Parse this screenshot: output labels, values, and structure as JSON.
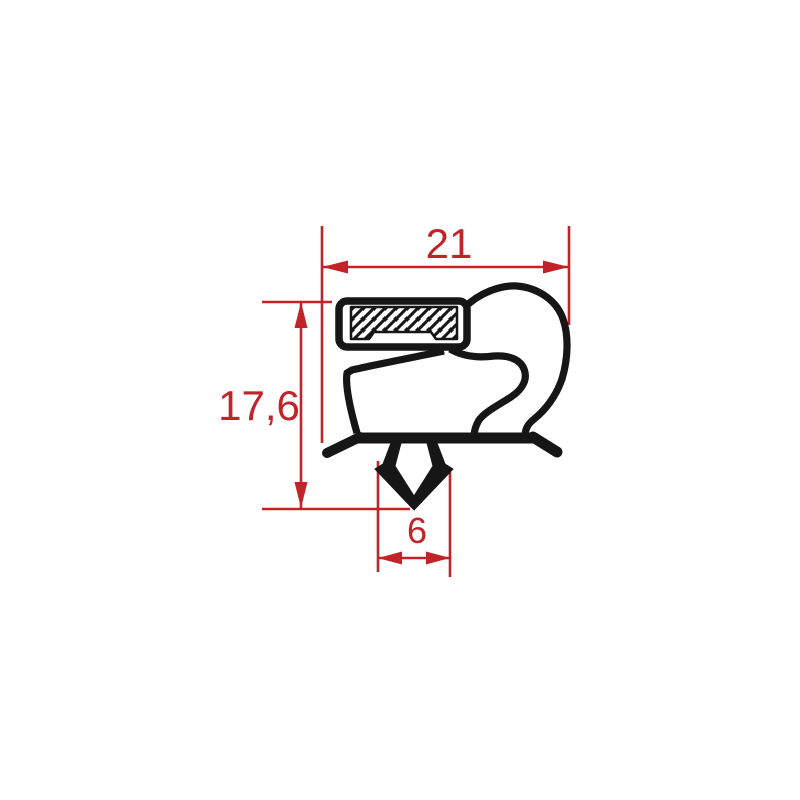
{
  "drawing": {
    "title": "gasket-profile-cross-section",
    "colors": {
      "background": "#ffffff",
      "profile": "#161616",
      "dimension": "#c22328"
    },
    "dimensions": {
      "overall_width": {
        "label": "21"
      },
      "overall_height": {
        "label": "17,6"
      },
      "anchor_width": {
        "label": "6"
      }
    }
  }
}
